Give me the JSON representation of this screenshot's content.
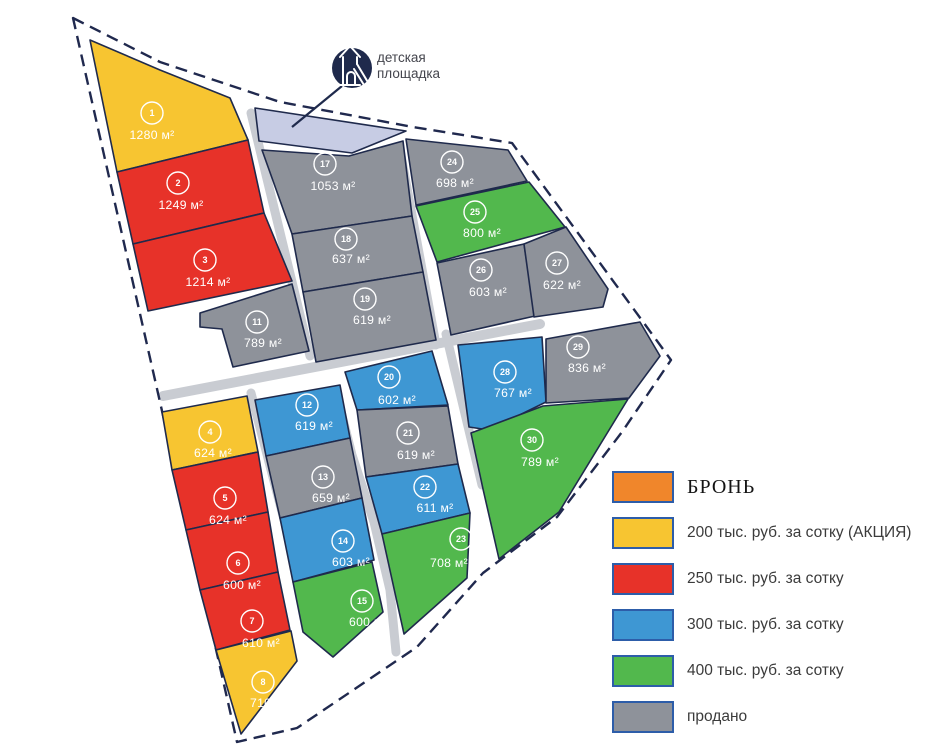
{
  "map": {
    "playground": {
      "label_line1": "детская",
      "label_line2": "площадка"
    },
    "palette": {
      "reserved": "#F0862B",
      "promo200": "#F7C531",
      "price250": "#E73229",
      "price300": "#3E97D3",
      "price400": "#52B84D",
      "sold": "#8E929A",
      "playground": "#C7CCE4",
      "navy": "#1F2A4C",
      "road": "#C9CCD2"
    },
    "plots": [
      {
        "id": "1",
        "area": "1280 м²",
        "status": "promo200"
      },
      {
        "id": "2",
        "area": "1249 м²",
        "status": "price250"
      },
      {
        "id": "3",
        "area": "1214 м²",
        "status": "price250"
      },
      {
        "id": "4",
        "area": "624 м²",
        "status": "promo200"
      },
      {
        "id": "5",
        "area": "624 м²",
        "status": "price250"
      },
      {
        "id": "6",
        "area": "600 м²",
        "status": "price250"
      },
      {
        "id": "7",
        "area": "610 м²",
        "status": "price250"
      },
      {
        "id": "8",
        "area": "710 м²",
        "status": "promo200"
      },
      {
        "id": "11",
        "area": "789 м²",
        "status": "sold"
      },
      {
        "id": "12",
        "area": "619 м²",
        "status": "price300"
      },
      {
        "id": "13",
        "area": "659 м²",
        "status": "sold"
      },
      {
        "id": "14",
        "area": "603 м²",
        "status": "price300"
      },
      {
        "id": "15",
        "area": "600 м²",
        "status": "price400"
      },
      {
        "id": "17",
        "area": "1053 м²",
        "status": "sold"
      },
      {
        "id": "18",
        "area": "637 м²",
        "status": "sold"
      },
      {
        "id": "19",
        "area": "619 м²",
        "status": "sold"
      },
      {
        "id": "20",
        "area": "602 м²",
        "status": "price300"
      },
      {
        "id": "21",
        "area": "619 м²",
        "status": "sold"
      },
      {
        "id": "22",
        "area": "611 м²",
        "status": "price300"
      },
      {
        "id": "23",
        "area": "708 м²",
        "status": "price400"
      },
      {
        "id": "24",
        "area": "698 м²",
        "status": "sold"
      },
      {
        "id": "25",
        "area": "800 м²",
        "status": "price400"
      },
      {
        "id": "26",
        "area": "603 м²",
        "status": "sold"
      },
      {
        "id": "27",
        "area": "622 м²",
        "status": "sold"
      },
      {
        "id": "28",
        "area": "767 м²",
        "status": "price300"
      },
      {
        "id": "29",
        "area": "836 м²",
        "status": "sold"
      },
      {
        "id": "30",
        "area": "789 м²",
        "status": "price400"
      }
    ]
  },
  "legend": {
    "items": [
      {
        "status": "reserved",
        "label": "БРОНЬ"
      },
      {
        "status": "promo200",
        "label": "200 тыс. руб. за сотку (АКЦИЯ)"
      },
      {
        "status": "price250",
        "label": "250 тыс. руб. за сотку"
      },
      {
        "status": "price300",
        "label": "300 тыс. руб. за сотку"
      },
      {
        "status": "price400",
        "label": "400 тыс. руб. за сотку"
      },
      {
        "status": "sold",
        "label": "продано"
      }
    ]
  }
}
